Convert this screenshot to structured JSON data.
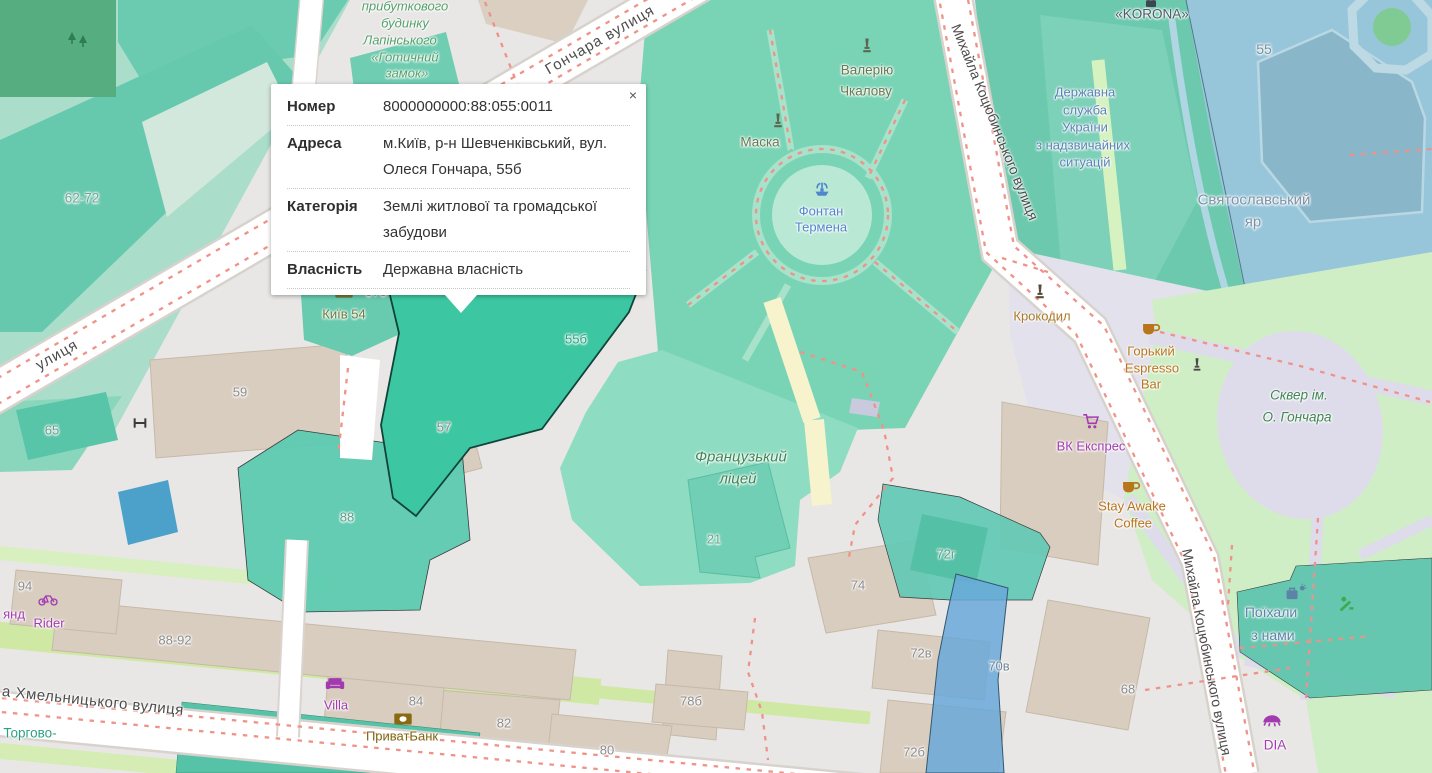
{
  "popup": {
    "close": "×",
    "rows": [
      {
        "label": "Номер",
        "value": "8000000000:88:055:0011"
      },
      {
        "label": "Адреса",
        "value": "м.Київ, р-н Шевченківський, вул. Олеся Гончара, 55б"
      },
      {
        "label": "Категорія",
        "value": "Землі житлової та громадської забудови"
      },
      {
        "label": "Власність",
        "value": "Державна власність"
      }
    ]
  },
  "streets": {
    "honchara": "Гончара вулиця",
    "ulytsia_partial": "улиця",
    "kotsiubynskoho": "Михайла Коцюбинського вулиця",
    "khmelnytskoho": "а Хмельницького вулиця"
  },
  "areas": {
    "prybutkovyi_lines": [
      "прибуткового",
      "будинку",
      "Лапінського",
      "«Готичний",
      "замок»"
    ],
    "valeriyu_lines": [
      "Валерію",
      "Чкалову"
    ],
    "maska": "Маска",
    "fontan_lines": [
      "Фонтан",
      "Термена"
    ],
    "derzhavna_lines": [
      "Державна",
      "служба",
      "України",
      "з надзвичайних",
      "ситуацій"
    ],
    "sviatoslavskyi_lines": [
      "Святославський",
      "яр"
    ],
    "korona": "«KORONA»",
    "frantsuzkyi_lines": [
      "Французький",
      "ліцей"
    ],
    "skver_lines": [
      "Сквер ім.",
      "О. Гончара"
    ],
    "poikhaly_lines": [
      "Поїхали",
      "з нами"
    ],
    "torhovo": "Торгово-",
    "kyiv54": "Київ 54"
  },
  "pois": {
    "horkyi_lines": [
      "Горький",
      "Espresso",
      "Bar"
    ],
    "stay_lines": [
      "Stay Awake",
      "Coffee"
    ],
    "vk": "ВК Експрес",
    "krokodyl": "Крокодил",
    "villa": "Villa",
    "pryvatbank": "ПриватБанк",
    "rider": "Rider",
    "rider_partial": "янд",
    "dia": "DIA"
  },
  "buildings": {
    "b62_72": "62-72",
    "b65": "65",
    "b59": "59",
    "b57": "57",
    "b57b": "57б",
    "b55b": "55б",
    "b88": "88",
    "b21": "21",
    "b74": "74",
    "b68": "68",
    "b72g": "72г",
    "b72v": "72в",
    "b70v": "70в",
    "b72b": "72б",
    "b78b": "78б",
    "b80": "80",
    "b82": "82",
    "b84": "84",
    "b88_92": "88-92",
    "b94": "94",
    "b55": "55"
  },
  "colors": {
    "selected_parcel": "#3cc6a1",
    "cadastral_teal": "#5ccab0",
    "water_blue_zone": "#97c6db",
    "park_green": "#79d4b6",
    "skver_green": "#cfeec5",
    "poi_purple": "#a23bb0",
    "poi_orange": "#b7761c",
    "road_dash_red": "#ef9288"
  }
}
